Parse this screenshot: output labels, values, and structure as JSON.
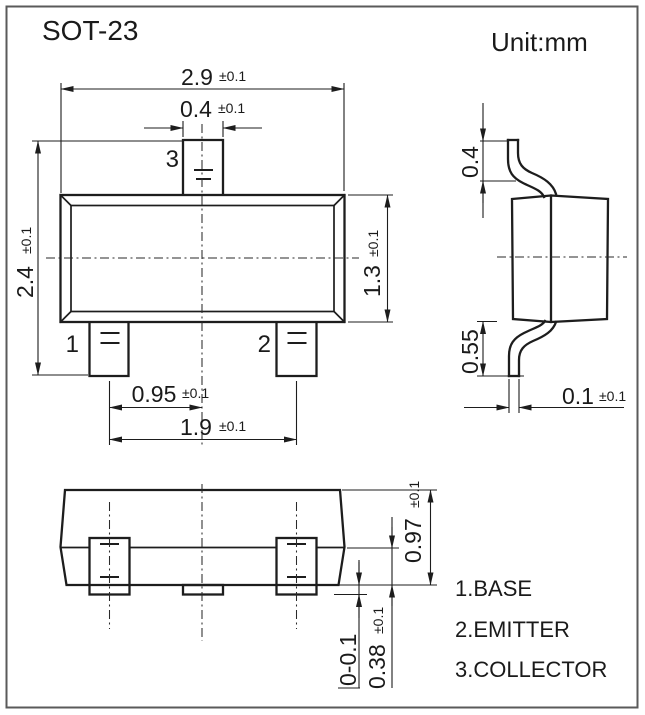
{
  "title": "SOT-23",
  "unit_label": "Unit:mm",
  "colors": {
    "line": "#1d1d1d",
    "border": "#5a5a5a",
    "background": "#ffffff"
  },
  "top_view": {
    "pin_labels": {
      "pin1": "1",
      "pin2": "2",
      "pin3": "3"
    },
    "dims": {
      "body_width": {
        "value": "2.9",
        "tol": "±0.1"
      },
      "pin_width": {
        "value": "0.4",
        "tol": "±0.1"
      },
      "overall_height": {
        "value": "2.4",
        "tol": "±0.1"
      },
      "body_height": {
        "value": "1.3",
        "tol": "±0.1"
      },
      "pin_pitch": {
        "value": "0.95",
        "tol": "±0.1"
      },
      "pin_span": {
        "value": "1.9",
        "tol": "±0.1"
      }
    }
  },
  "side_view": {
    "dims": {
      "top_lead_height": {
        "value": "0.4"
      },
      "bottom_lead_height": {
        "value": "0.55"
      },
      "lead_thickness": {
        "value": "0.1",
        "tol": "±0.1"
      }
    }
  },
  "front_view": {
    "dims": {
      "total_height": {
        "value": "0.97",
        "tol": "±0.1"
      },
      "lower_body_height": {
        "value": "0.38",
        "tol": "±0.1"
      },
      "standoff": {
        "value": "0-0.1"
      }
    }
  },
  "legend": {
    "items": [
      {
        "label": "1.BASE"
      },
      {
        "label": "2.EMITTER"
      },
      {
        "label": "3.COLLECTOR"
      }
    ]
  }
}
